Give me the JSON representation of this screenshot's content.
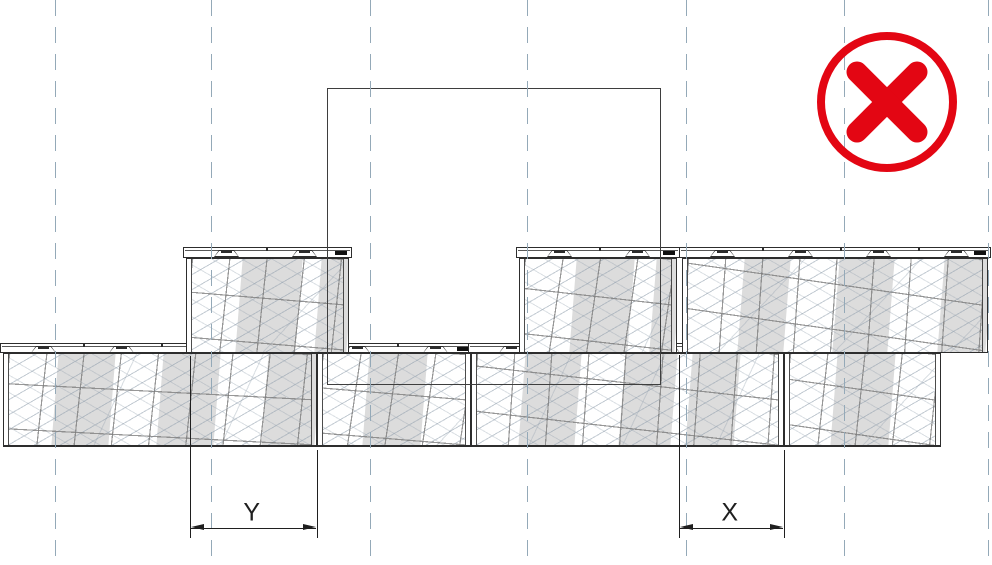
{
  "canvas": {
    "w": 992,
    "h": 565
  },
  "colors": {
    "line": "#2d2d2d",
    "ghost": "#3e3e3e",
    "guide": "#94a9b8",
    "band": "#dcdcdc",
    "dim": "#1f1f1f",
    "red": "#e30613",
    "hatch": "rgba(146,160,174,0.55)",
    "hatch2": "rgba(146,160,174,0.33)",
    "grid": "rgba(122,122,122,0.78)"
  },
  "guides": {
    "xs": [
      55,
      211,
      370,
      527,
      686,
      844,
      988
    ]
  },
  "prohibition_icon": {
    "cx": 887,
    "cy": 102,
    "r": 66,
    "ring_w": 8,
    "cross_half": 30,
    "cross_w": 21
  },
  "misplaced_block": {
    "x": 327,
    "y": 88,
    "w": 334,
    "h": 297
  },
  "wall": {
    "lug": {
      "start": 27,
      "w": 25,
      "pitch": 78,
      "h": 7
    },
    "mark": {
      "w": 12,
      "h": 4
    },
    "courses": [
      {
        "id": "bottom",
        "y": 343,
        "cap_h": 10,
        "h": 104,
        "z": 2,
        "base": true,
        "blocks": [
          {
            "id": "B1",
            "x": 3,
            "w": 314,
            "seed": 4,
            "bands": [
              [
                51,
                57
              ],
              [
                156,
                57
              ],
              [
                261,
                53
              ]
            ]
          },
          {
            "id": "B2",
            "x": 317,
            "w": 154,
            "seed": 5,
            "bands": [
              [
                48,
                58
              ]
            ]
          },
          {
            "id": "B3",
            "x": 471,
            "w": 313,
            "seed": 6,
            "bands": [
              [
                50,
                56
              ],
              [
                150,
                52
              ],
              [
                217,
                48
              ]
            ]
          },
          {
            "id": "B4",
            "x": 784,
            "w": 157,
            "seed": 7,
            "bands": [
              [
                49,
                58
              ]
            ]
          }
        ]
      },
      {
        "id": "top",
        "y": 247,
        "cap_h": 11,
        "h": 106,
        "z": 3,
        "base": false,
        "blocks": [
          {
            "id": "T1",
            "x": 186,
            "w": 163,
            "seed": 1,
            "bands": [
              [
                52,
                60
              ],
              [
                131,
                32
              ]
            ]
          },
          {
            "id": "T2",
            "x": 519,
            "w": 158,
            "seed": 2,
            "bands": [
              [
                53,
                58
              ],
              [
                133,
                25
              ]
            ]
          },
          {
            "id": "T3",
            "x": 682,
            "w": 306,
            "seed": 3,
            "bands": [
              [
                58,
                46
              ],
              [
                153,
                55
              ],
              [
                258,
                48
              ]
            ]
          }
        ]
      }
    ]
  },
  "dimensions": [
    {
      "label": "Y",
      "x1": 190,
      "x2": 317,
      "line_y": 528,
      "ext1_top": 356,
      "ext2_top": 450,
      "ext_bottom": 538,
      "label_x": 252,
      "label_y": 513
    },
    {
      "label": "X",
      "x1": 679,
      "x2": 784,
      "line_y": 528,
      "ext1_top": 355,
      "ext2_top": 450,
      "ext_bottom": 538,
      "label_x": 730,
      "label_y": 513
    }
  ]
}
